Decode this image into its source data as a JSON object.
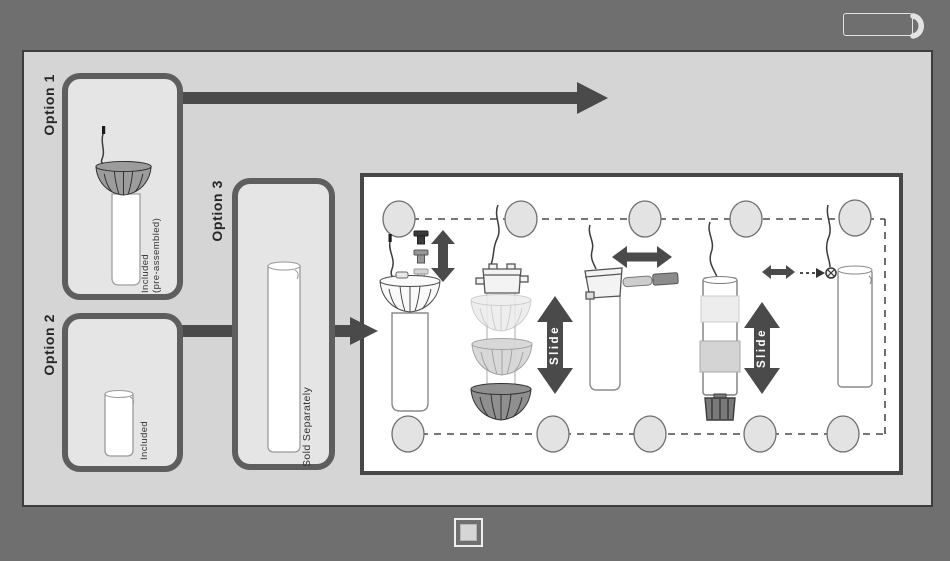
{
  "labels": {
    "options": [
      {
        "label": "Option 1",
        "note_line1": "Included",
        "note_line2": "(pre-assembled)"
      },
      {
        "label": "Option 2",
        "note_line1": "Included"
      },
      {
        "label": "Option 3",
        "note_line1": "Sold Separately"
      }
    ]
  },
  "assembly": {
    "slide_labels": [
      "Slide",
      "Slide"
    ]
  },
  "icons": {
    "top_right": "handset-icon",
    "bottom_center": "page-indicator-icon"
  },
  "colors": {
    "background": "#6f6f6f",
    "panel": "#d5d5d5",
    "option_box_fill": "#e5e5e5",
    "option_box_border": "#5e5e5e",
    "arrow": "#4a4a4a",
    "white_panel": "#ffffff",
    "collar_gray": "#9c9c9c"
  }
}
